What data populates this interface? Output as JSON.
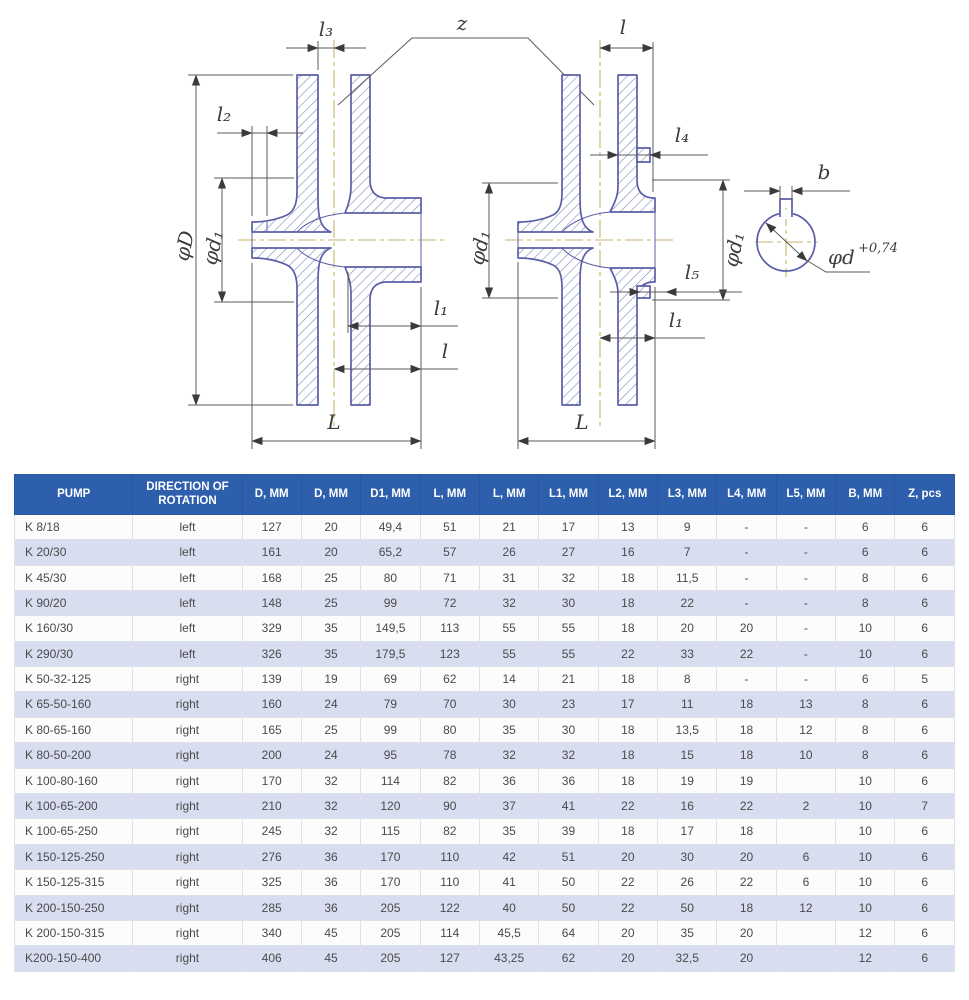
{
  "colors": {
    "header_bg": "#2d5fad",
    "row_alt": "#d8def0",
    "row_base": "#fcfcfd",
    "outline_blue": "#5a5ea6",
    "hatch_blue": "#8289bd",
    "centerline_olive": "#c6b46c"
  },
  "drawing": {
    "labels": {
      "z": "z",
      "l": "l",
      "l1": "l₁",
      "l2": "l₂",
      "l3": "l₃",
      "l4": "l₄",
      "l5": "l₅",
      "L": "L",
      "phiD": "φD",
      "phid1": "φd₁",
      "b": "b",
      "phid": "φd",
      "phid_tol": "+0,74"
    }
  },
  "table": {
    "columns": [
      "PUMP",
      "DIRECTION OF ROTATION",
      "D, MM",
      "D, MM",
      "D1, MM",
      "L, MM",
      "L, MM",
      "L1, MM",
      "L2, MM",
      "L3, MM",
      "L4, MM",
      "L5, MM",
      "B, MM",
      "Z, pcs"
    ],
    "rows": [
      [
        "K 8/18",
        "left",
        "127",
        "20",
        "49,4",
        "51",
        "21",
        "17",
        "13",
        "9",
        "-",
        "-",
        "6",
        "6"
      ],
      [
        "K 20/30",
        "left",
        "161",
        "20",
        "65,2",
        "57",
        "26",
        "27",
        "16",
        "7",
        "-",
        "-",
        "6",
        "6"
      ],
      [
        "K 45/30",
        "left",
        "168",
        "25",
        "80",
        "71",
        "31",
        "32",
        "18",
        "11,5",
        "-",
        "-",
        "8",
        "6"
      ],
      [
        "K 90/20",
        "left",
        "148",
        "25",
        "99",
        "72",
        "32",
        "30",
        "18",
        "22",
        "-",
        "-",
        "8",
        "6"
      ],
      [
        "K 160/30",
        "left",
        "329",
        "35",
        "149,5",
        "113",
        "55",
        "55",
        "18",
        "20",
        "20",
        "-",
        "10",
        "6"
      ],
      [
        "K 290/30",
        "left",
        "326",
        "35",
        "179,5",
        "123",
        "55",
        "55",
        "22",
        "33",
        "22",
        "-",
        "10",
        "6"
      ],
      [
        "K 50-32-125",
        "right",
        "139",
        "19",
        "69",
        "62",
        "14",
        "21",
        "18",
        "8",
        "-",
        "-",
        "6",
        "5"
      ],
      [
        "K 65-50-160",
        "right",
        "160",
        "24",
        "79",
        "70",
        "30",
        "23",
        "17",
        "11",
        "18",
        "13",
        "8",
        "6"
      ],
      [
        "K 80-65-160",
        "right",
        "165",
        "25",
        "99",
        "80",
        "35",
        "30",
        "18",
        "13,5",
        "18",
        "12",
        "8",
        "6"
      ],
      [
        "K 80-50-200",
        "right",
        "200",
        "24",
        "95",
        "78",
        "32",
        "32",
        "18",
        "15",
        "18",
        "10",
        "8",
        "6"
      ],
      [
        "K 100-80-160",
        "right",
        "170",
        "32",
        "114",
        "82",
        "36",
        "36",
        "18",
        "19",
        "19",
        "",
        "10",
        "6"
      ],
      [
        "K 100-65-200",
        "right",
        "210",
        "32",
        "120",
        "90",
        "37",
        "41",
        "22",
        "16",
        "22",
        "2",
        "10",
        "7"
      ],
      [
        "K 100-65-250",
        "right",
        "245",
        "32",
        "115",
        "82",
        "35",
        "39",
        "18",
        "17",
        "18",
        "",
        "10",
        "6"
      ],
      [
        "K 150-125-250",
        "right",
        "276",
        "36",
        "170",
        "110",
        "42",
        "51",
        "20",
        "30",
        "20",
        "6",
        "10",
        "6"
      ],
      [
        "K 150-125-315",
        "right",
        "325",
        "36",
        "170",
        "110",
        "41",
        "50",
        "22",
        "26",
        "22",
        "6",
        "10",
        "6"
      ],
      [
        "K 200-150-250",
        "right",
        "285",
        "36",
        "205",
        "122",
        "40",
        "50",
        "22",
        "50",
        "18",
        "12",
        "10",
        "6"
      ],
      [
        "K 200-150-315",
        "right",
        "340",
        "45",
        "205",
        "114",
        "45,5",
        "64",
        "20",
        "35",
        "20",
        "",
        "12",
        "6"
      ],
      [
        "K200-150-400",
        "right",
        "406",
        "45",
        "205",
        "127",
        "43,25",
        "62",
        "20",
        "32,5",
        "20",
        "",
        "12",
        "6"
      ]
    ]
  }
}
